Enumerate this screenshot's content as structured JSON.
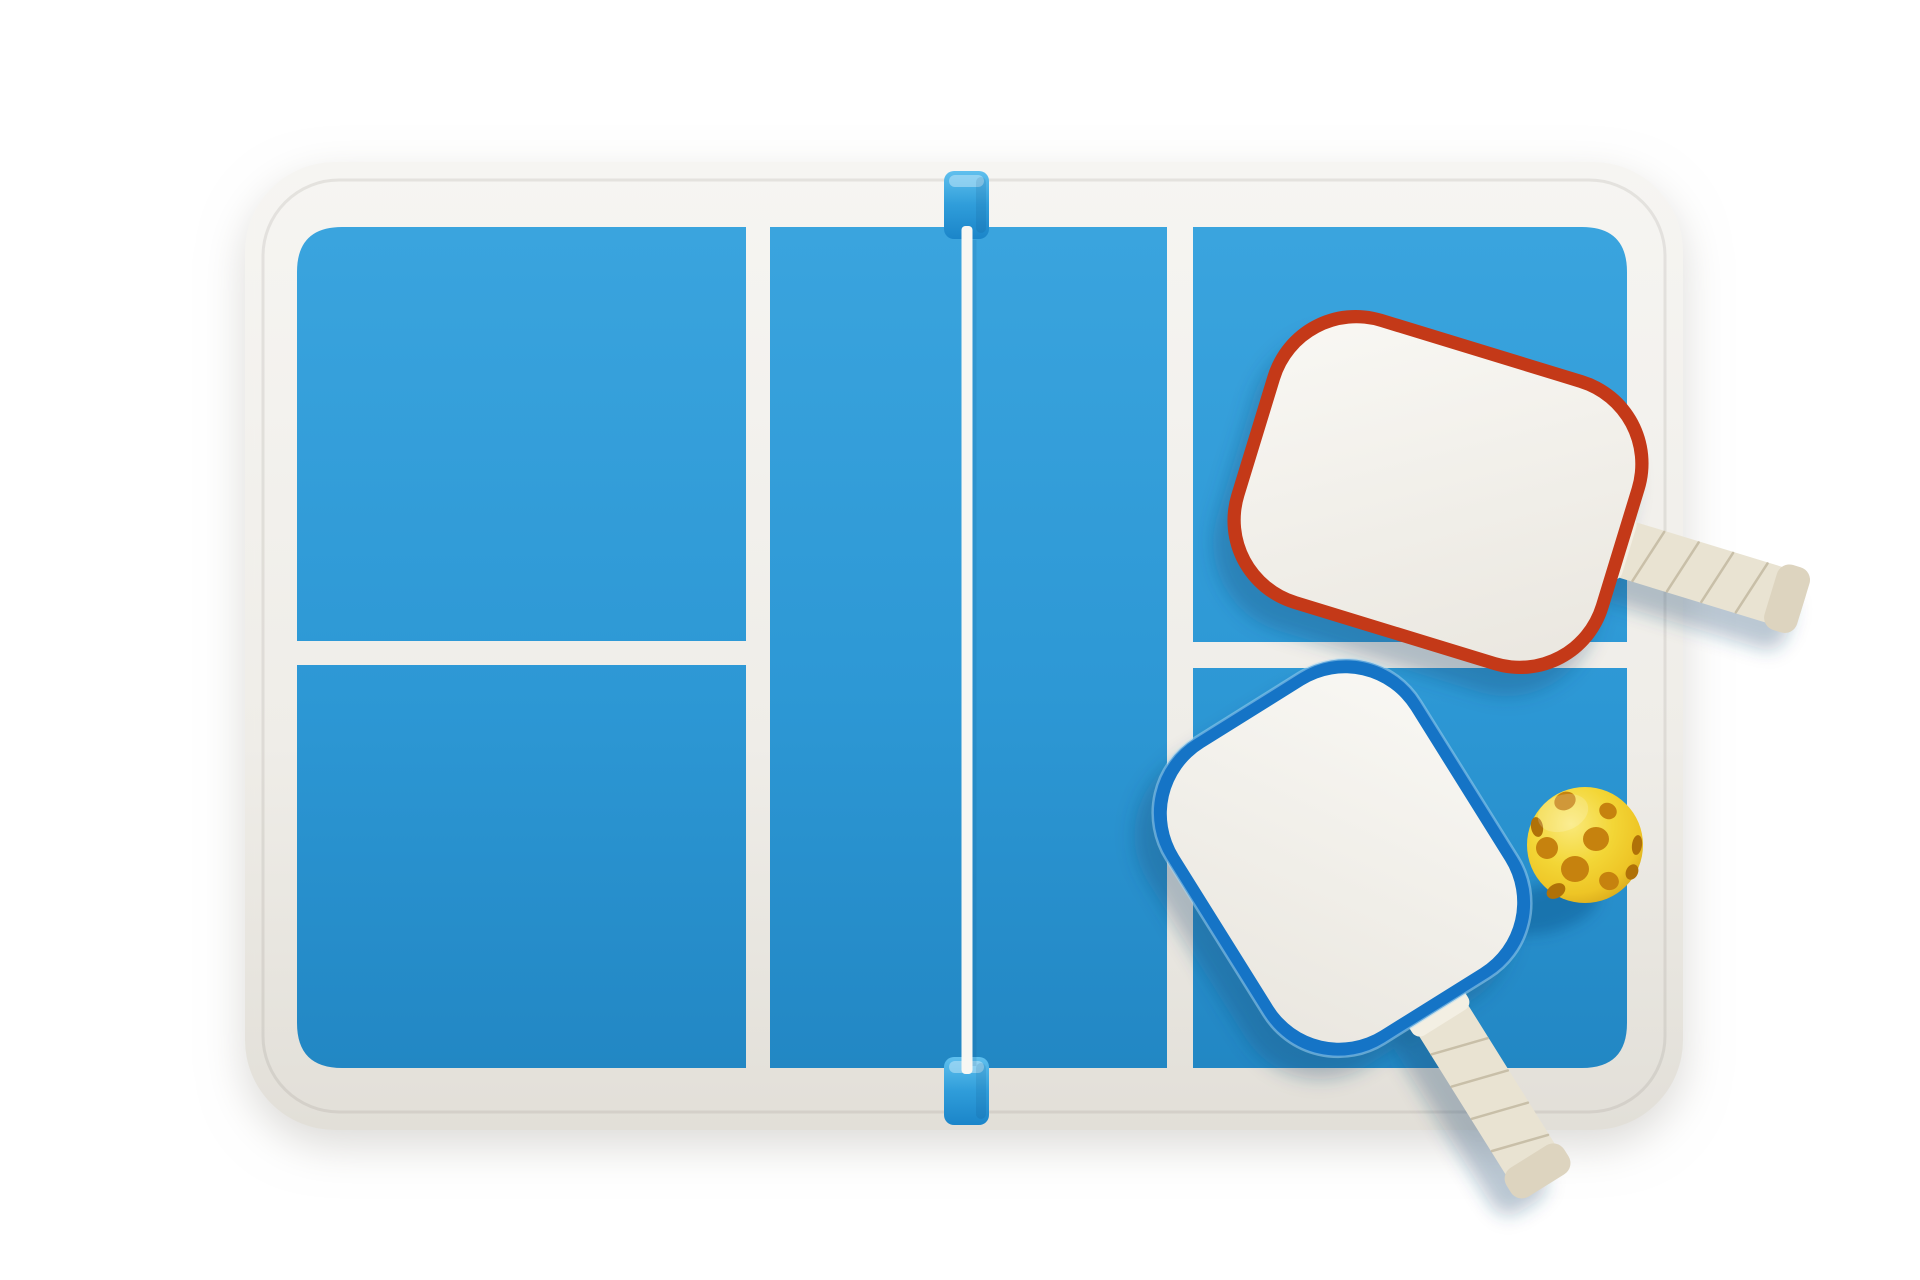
{
  "scene": {
    "description": "Top-down 3D render of a miniature pickleball court table with two paddles and a perforated pickleball",
    "objects": [
      "white rounded table platform",
      "blue pickleball court surface with white lines",
      "white net line with blue post clips",
      "white paddle with red edge guard and wrapped handle",
      "white paddle with blue edge guard and wrapped handle",
      "yellow pickleball with holes"
    ]
  },
  "colors": {
    "page_bg": "#ffffff",
    "platform_top": "#f6f5f2",
    "platform_mid": "#efede8",
    "platform_low": "#e2dfd8",
    "platform_crease": "rgba(120,115,105,0.14)",
    "court_top": "#3aa4de",
    "court_mid": "#2d98d5",
    "court_low": "#2287c4",
    "net_line": "#f8f7f3",
    "net_line_shadow": "rgba(15,75,125,0.12)",
    "clip_top": "#60c0ee",
    "clip_mid": "#2f9dda",
    "clip_low": "#1b85c9",
    "clip_highlight": "#bfe6f8",
    "clip_shade": "rgba(10,60,110,0.25)",
    "face_hi": "#f9f8f4",
    "face_low": "#ebe8e1",
    "red_edge": "#c43918",
    "blue_edge": "#1574c6",
    "blue_edge_highlight": "#a8d8f2",
    "wrap": "#e9e3d2",
    "wrap_line": "#c3b9a1",
    "wrap_collar": "#f3efe3",
    "wrap_end": "#ddd4bf",
    "ball_hi": "#fae97a",
    "ball_mid": "#f3d636",
    "ball_deep": "#eec526",
    "ball_low": "#d2a018",
    "hole": "#c6820e",
    "hole_edge": "#b07108",
    "shadow": "rgba(35,70,110,0.30)",
    "ball_shadow": "rgba(15,70,120,0.35)",
    "specular": "rgba(255,255,255,0.18)"
  }
}
